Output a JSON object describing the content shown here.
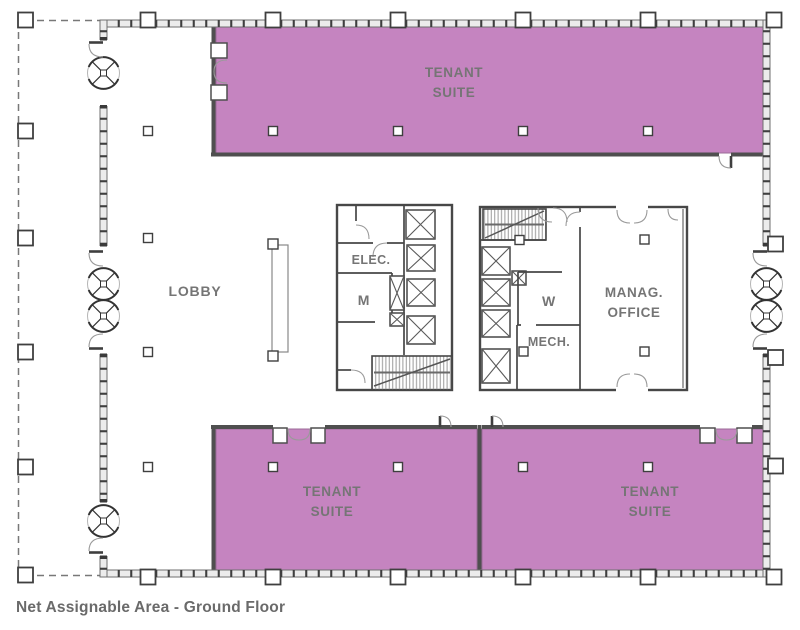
{
  "caption": {
    "text": "Net Assignable Area - Ground Floor"
  },
  "colors": {
    "suite_fill": "#c584c0",
    "suite_outline": "#9b6b97",
    "wall_line": "#3f3f3f",
    "wall_fill": "#ececec",
    "room_label_text": "#757575",
    "caption_text": "#6a6a6a"
  },
  "rooms": {
    "lobby": {
      "label": "LOBBY"
    },
    "tenant_suite_top": {
      "line1": "TENANT",
      "line2": "SUITE"
    },
    "tenant_suite_bottom_left": {
      "line1": "TENANT",
      "line2": "SUITE"
    },
    "tenant_suite_bottom_right": {
      "line1": "TENANT",
      "line2": "SUITE"
    },
    "electrical": {
      "label": "ELEC."
    },
    "mens_restroom": {
      "label": "M"
    },
    "womens_restroom": {
      "label": "W"
    },
    "mechanical": {
      "label": "MECH."
    },
    "management_office": {
      "line1": "MANAG.",
      "line2": "OFFICE"
    }
  },
  "icons": {
    "revolving_door": "revolving-door-icon",
    "swing_door": "swing-door-icon",
    "elevator": "elevator-icon",
    "stair": "stair-icon",
    "column": "column-marker"
  }
}
